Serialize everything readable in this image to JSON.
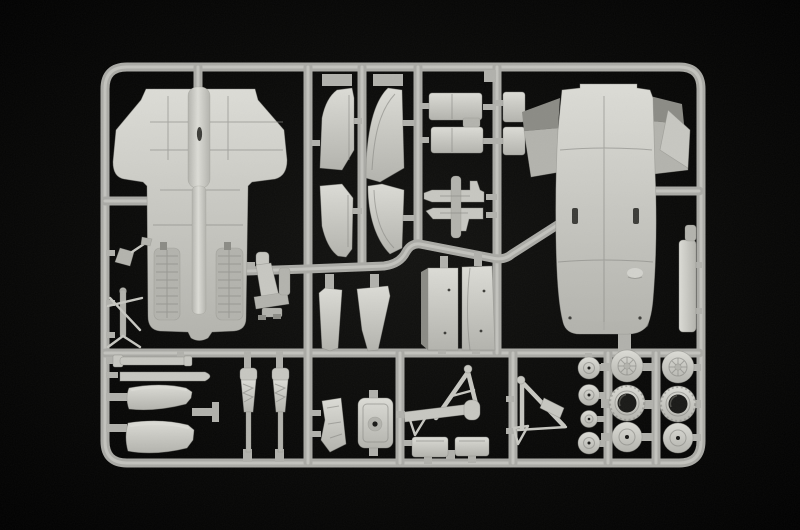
{
  "scene": {
    "subject": "Photograph of a light-grey injection-moulded model kit sprue with unassembled aircraft parts on a black background",
    "colors": {
      "background": "#030303",
      "glow": "#131311",
      "plastic": "#c7c7c1",
      "plastic_bright": "#dcdcd6",
      "plastic_mid": "#b3b3ad",
      "plastic_dark": "#8b8b85",
      "runner": "#aaaaa5",
      "runner_highlight": "#cfcfc9",
      "gate": "#b1b1ac",
      "recess": "#191917",
      "slot": "#3c3c38"
    }
  },
  "parts": [
    {
      "label": "Upper fuselage and wing section"
    },
    {
      "label": "Ejection seat"
    },
    {
      "label": "Fin half (upper, inner)"
    },
    {
      "label": "Fin half (lower, inner)"
    },
    {
      "label": "Fin half (upper, outer)"
    },
    {
      "label": "Fin half (lower, outer)"
    },
    {
      "label": "Intake wedge (left)"
    },
    {
      "label": "Intake wedge (right)"
    },
    {
      "label": "Airbrake and access door panels"
    },
    {
      "label": "Missile / pylon halves"
    },
    {
      "label": "Intake trunk (left)"
    },
    {
      "label": "Intake trunk (right)"
    },
    {
      "label": "Lower fuselage with wing roots"
    },
    {
      "label": "Fuselage side panel"
    },
    {
      "label": "Pitot / probe assembly"
    },
    {
      "label": "Small landing gear leg"
    },
    {
      "label": "Actuator strip (short)"
    },
    {
      "label": "Actuator strip (long)"
    },
    {
      "label": "Nose cone half (upper)"
    },
    {
      "label": "Nose cone half (lower)"
    },
    {
      "label": "Oleo strut (left)"
    },
    {
      "label": "Oleo strut (right)"
    },
    {
      "label": "Cockpit bracket"
    },
    {
      "label": "Engine bulkhead"
    },
    {
      "label": "Main gear A-frame (left)"
    },
    {
      "label": "Main gear A-frame (right)"
    },
    {
      "label": "Gear door (left)"
    },
    {
      "label": "Gear door (right)"
    },
    {
      "label": "Nose wheels (four)"
    },
    {
      "label": "Main wheels with hub recesses (six)"
    }
  ]
}
